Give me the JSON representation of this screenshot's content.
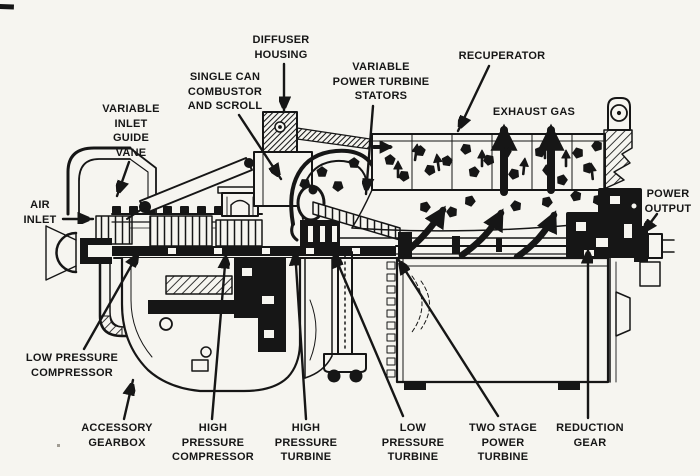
{
  "colors": {
    "paper": "#f6f5f0",
    "ink": "#161616"
  },
  "diagram": {
    "kind": "gas-turbine-engine-cutaway",
    "labels": [
      {
        "id": "diffuser-housing",
        "x": 281,
        "y": 33,
        "lines": [
          "DIFFUSER",
          "HOUSING"
        ],
        "leader": [
          284,
          64,
          284,
          112
        ]
      },
      {
        "id": "single-can-combustor-and-scroll",
        "x": 225,
        "y": 70,
        "lines": [
          "SINGLE CAN",
          "COMBUSTOR",
          "AND SCROLL"
        ],
        "leader": [
          239,
          115,
          281,
          179
        ]
      },
      {
        "id": "variable-inlet-guide-vane",
        "x": 131,
        "y": 102,
        "lines": [
          "VARIABLE",
          "INLET",
          "GUIDE",
          "VANE"
        ],
        "leader": [
          129,
          162,
          117,
          196
        ]
      },
      {
        "id": "air-inlet",
        "x": 40,
        "y": 198,
        "lines": [
          "AIR",
          "INLET"
        ],
        "leader": [
          63,
          219,
          93,
          219
        ]
      },
      {
        "id": "variable-power-turbine-stators",
        "x": 381,
        "y": 60,
        "lines": [
          "VARIABLE",
          "POWER TURBINE",
          "STATORS"
        ],
        "leader": [
          373,
          106,
          366,
          194
        ]
      },
      {
        "id": "recuperator",
        "x": 502,
        "y": 49,
        "lines": [
          "RECUPERATOR"
        ],
        "leader": [
          489,
          66,
          458,
          131
        ]
      },
      {
        "id": "exhaust-gas",
        "x": 534,
        "y": 105,
        "lines": [
          "EXHAUST GAS"
        ],
        "leader": null
      },
      {
        "id": "power-output",
        "x": 668,
        "y": 187,
        "lines": [
          "POWER",
          "OUTPUT"
        ],
        "leader": [
          657,
          214,
          642,
          234
        ]
      },
      {
        "id": "low-pressure-compressor",
        "x": 72,
        "y": 351,
        "lines": [
          "LOW PRESSURE",
          "COMPRESSOR"
        ],
        "leader": [
          84,
          349,
          139,
          252
        ]
      },
      {
        "id": "accessory-gearbox",
        "x": 117,
        "y": 421,
        "lines": [
          "ACCESSORY",
          "GEARBOX"
        ],
        "leader": [
          124,
          419,
          133,
          380
        ]
      },
      {
        "id": "high-pressure-compressor",
        "x": 213,
        "y": 421,
        "lines": [
          "HIGH",
          "PRESSURE",
          "COMPRESSOR"
        ],
        "leader": [
          212,
          419,
          226,
          253
        ]
      },
      {
        "id": "high-pressure-turbine",
        "x": 306,
        "y": 421,
        "lines": [
          "HIGH",
          "PRESSURE",
          "TURBINE"
        ],
        "leader": [
          306,
          419,
          295,
          250
        ]
      },
      {
        "id": "low-pressure-turbine",
        "x": 413,
        "y": 421,
        "lines": [
          "LOW",
          "PRESSURE",
          "TURBINE"
        ],
        "leader": [
          403,
          416,
          333,
          252
        ]
      },
      {
        "id": "two-stage-power-turbine",
        "x": 503,
        "y": 421,
        "lines": [
          "TWO STAGE",
          "POWER",
          "TURBINE"
        ],
        "leader": [
          498,
          416,
          398,
          259
        ]
      },
      {
        "id": "reduction-gear",
        "x": 590,
        "y": 421,
        "lines": [
          "REDUCTION",
          "GEAR"
        ],
        "leader": [
          588,
          418,
          588,
          248
        ]
      }
    ]
  }
}
